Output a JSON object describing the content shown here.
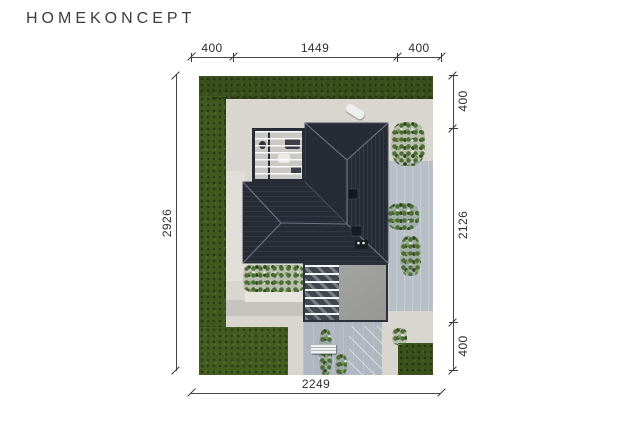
{
  "brand": {
    "logo": "HOMEKONCEPT"
  },
  "dimensions": {
    "top": {
      "segments": [
        "400",
        "1449",
        "400"
      ]
    },
    "bottom": {
      "total": "2249"
    },
    "left": {
      "total": "2926"
    },
    "right": {
      "segments": [
        "400",
        "2126",
        "400"
      ]
    }
  },
  "scene": {
    "description": "Aerial top view of a detached house with dark hip roof, terrace pergola, garage, driveway and lawn on a rectangular plot",
    "colors": {
      "roof": "#272b36",
      "roof_lines": "#7b8290",
      "grass": "#40591f",
      "paving_warm": "#d8d6cf",
      "paving_cool": "#b9bfc7",
      "garage_roof": "#9e9e9c",
      "dimension": "#3a3a3a",
      "logo": "#3c3c3c"
    }
  }
}
